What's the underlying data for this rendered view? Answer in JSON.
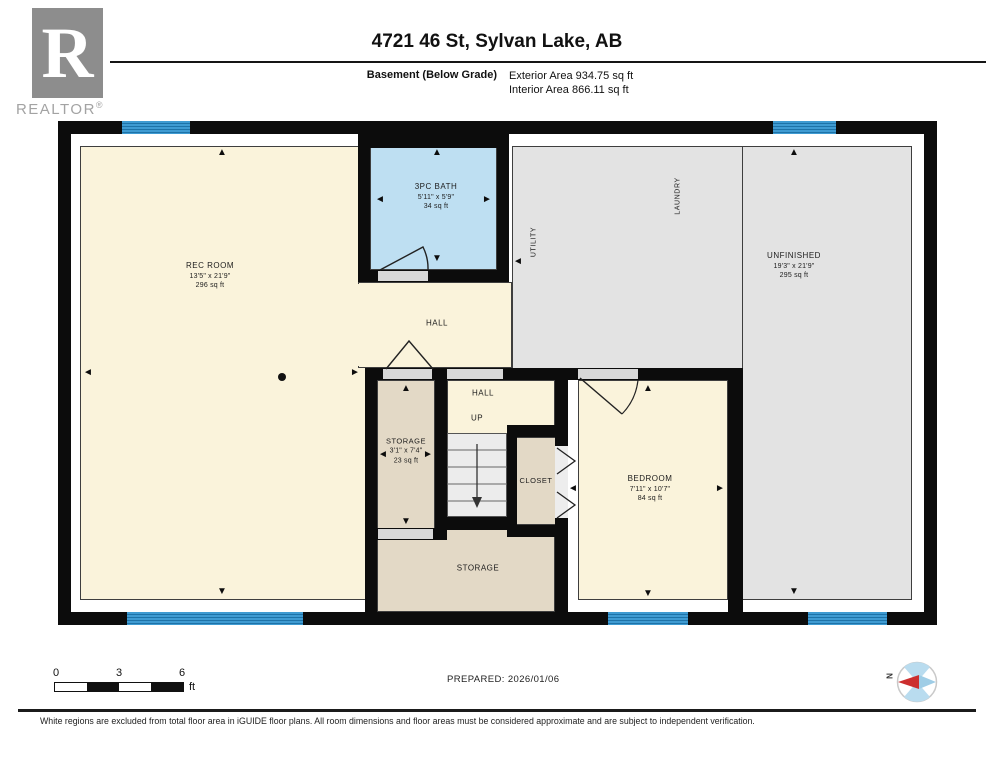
{
  "header": {
    "logo_r": "R",
    "logo_text": "REALTOR",
    "logo_reg": "®",
    "title": "4721 46 St, Sylvan Lake, AB",
    "floor_label": "Basement (Below Grade)",
    "exterior_area": "Exterior Area 934.75 sq ft",
    "interior_area": "Interior Area 866.11 sq ft"
  },
  "plan": {
    "rooms": {
      "rec_room": {
        "name": "REC ROOM",
        "dims": "13'5\" x 21'9\"",
        "area": "296 sq ft"
      },
      "bath": {
        "name": "3PC BATH",
        "dims": "5'11\" x 5'9\"",
        "area": "34 sq ft"
      },
      "utility": {
        "name": "UTILITY"
      },
      "laundry": {
        "name": "LAUNDRY"
      },
      "unfinished": {
        "name": "UNFINISHED",
        "dims": "19'3\" x 21'9\"",
        "area": "295 sq ft"
      },
      "hall_upper": {
        "name": "HALL"
      },
      "hall_lower": {
        "name": "HALL",
        "up": "UP"
      },
      "storage_small": {
        "name": "STORAGE",
        "dims": "3'1\" x 7'4\"",
        "area": "23 sq ft"
      },
      "closet": {
        "name": "CLOSET"
      },
      "bedroom": {
        "name": "BEDROOM",
        "dims": "7'11\" x 10'7\"",
        "area": "84 sq ft"
      },
      "storage_large": {
        "name": "STORAGE"
      }
    },
    "colors": {
      "wall": "#0C0C0C",
      "cream": "#FAF3DB",
      "bath_blue": "#BEDFF2",
      "gray": "#E3E3E3",
      "tan": "#E3D9C6",
      "stairs": "#ECECEC",
      "window_blue": "#3F9BD2",
      "sill": "#D8D8D8",
      "compass_red": "#CC2F2F"
    },
    "icons": {
      "arrow_up": "▲",
      "arrow_down": "▼",
      "arrow_left": "◄",
      "arrow_right": "►"
    }
  },
  "footer": {
    "scale": {
      "t0": "0",
      "t3": "3",
      "t6": "6",
      "unit": "ft"
    },
    "prepared": "PREPARED: 2026/01/06",
    "compass_n": "N",
    "disclaimer": "White regions are excluded from total floor area in iGUIDE floor plans. All room dimensions and floor areas must be considered approximate and are subject to independent verification."
  }
}
